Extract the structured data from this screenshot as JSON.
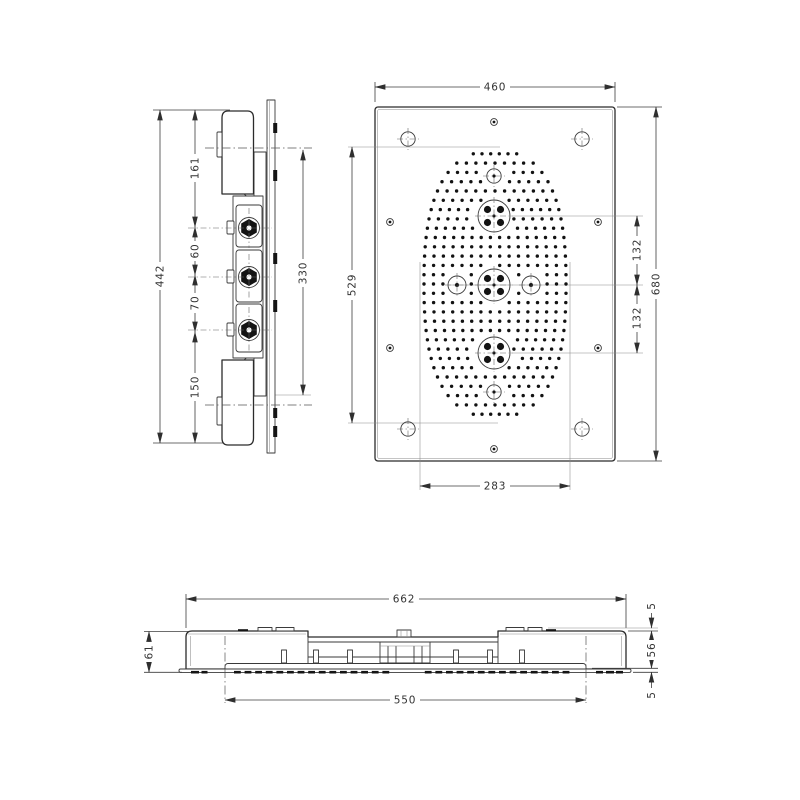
{
  "drawing": {
    "line_color": "#2b2b2b",
    "dim_color": "#3c3c3c",
    "background": "#ffffff"
  },
  "side_view": {
    "dims": {
      "overall_height": "442",
      "segment_top": "161",
      "segment_upper": "60",
      "segment_lower": "70",
      "segment_bottom": "150",
      "mounting_plate_height": "330"
    }
  },
  "front_view": {
    "dims": {
      "overall_width": "460",
      "spray_field_height": "529",
      "overall_height": "680",
      "jet_spacing_upper": "132",
      "jet_spacing_lower": "132",
      "spray_field_width": "283"
    }
  },
  "bottom_view": {
    "dims": {
      "overall_width": "662",
      "spray_plate_width": "550",
      "recess_depth": "61",
      "clearance_top": "5",
      "housing_depth": "56",
      "panel_projection": "5"
    }
  }
}
